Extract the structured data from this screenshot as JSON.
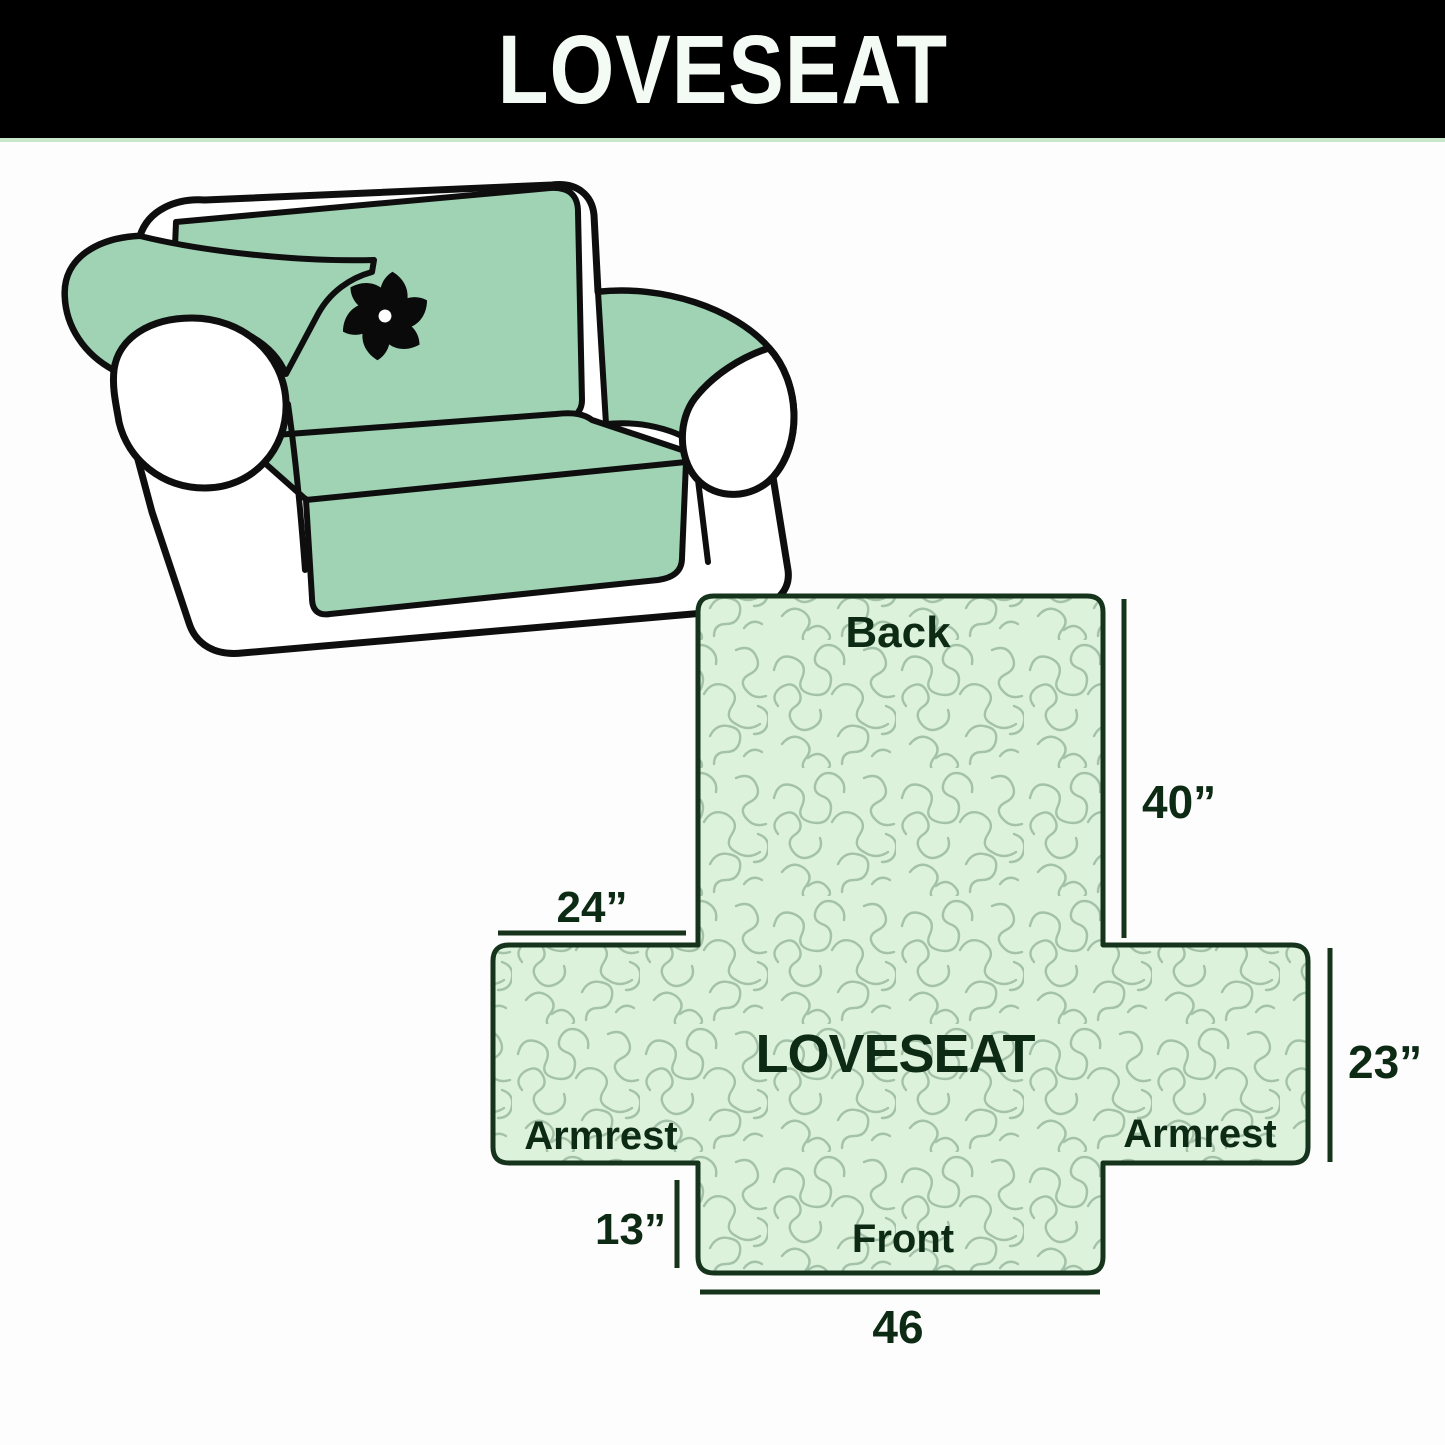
{
  "header": {
    "title": "LOVESEAT"
  },
  "sofa": {
    "illustration": "loveseat-with-slipcover",
    "logo_icon": "pinwheel-icon"
  },
  "diagram": {
    "center_label": "LOVESEAT",
    "labels": {
      "back": "Back",
      "front": "Front",
      "armrest_left": "Armrest",
      "armrest_right": "Armrest"
    },
    "dimensions": {
      "back_height": "40”",
      "armrest_top_width": "24”",
      "armrest_height": "23”",
      "front_height": "13”",
      "front_width": "46"
    }
  },
  "colors": {
    "header_bg": "#000000",
    "header_text": "#f4faf4",
    "divider_green": "#c8e8cc",
    "cover_green": "#9fd3b4",
    "diagram_fill": "#dcf2da",
    "pattern_line": "#a3c2a7",
    "outline_dark": "#16331c",
    "label_text": "#0d2a14",
    "sofa_outline": "#0e0e0e",
    "logo_black": "#0a0a0a"
  }
}
